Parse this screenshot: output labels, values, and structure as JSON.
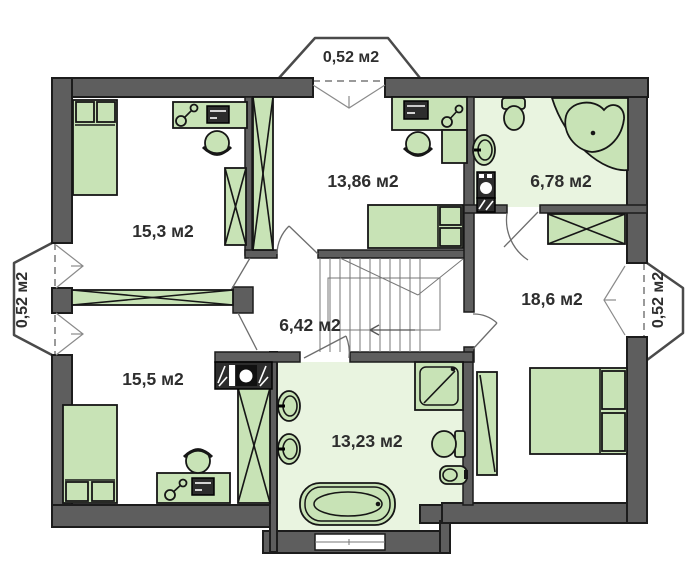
{
  "plan": {
    "title": "Floor plan — upper storey",
    "area_unit": "м2",
    "rooms": [
      {
        "id": "room-15-3",
        "label": "15,3 м2"
      },
      {
        "id": "room-13-86",
        "label": "13,86 м2"
      },
      {
        "id": "bath-6-78",
        "label": "6,78 м2"
      },
      {
        "id": "room-18-6",
        "label": "18,6 м2"
      },
      {
        "id": "hall-6-42",
        "label": "6,42 м2"
      },
      {
        "id": "room-15-5",
        "label": "15,5 м2"
      },
      {
        "id": "bath-13-23",
        "label": "13,23 м2"
      },
      {
        "id": "bay-top",
        "label": "0,52 м2"
      },
      {
        "id": "bay-left",
        "label": "0,52 м2"
      },
      {
        "id": "bay-right",
        "label": "0,52 м2"
      }
    ]
  },
  "colors": {
    "wall": "#5e5e5e",
    "wallstroke": "#1c1c1c",
    "furn": "#c8e3b6",
    "furnstroke": "#161616",
    "floor": "#e9f4e0",
    "thin": "#8a8a8a",
    "dark": "#2d2d2d",
    "text": "#2e2e2e",
    "bg": "#ffffff"
  }
}
